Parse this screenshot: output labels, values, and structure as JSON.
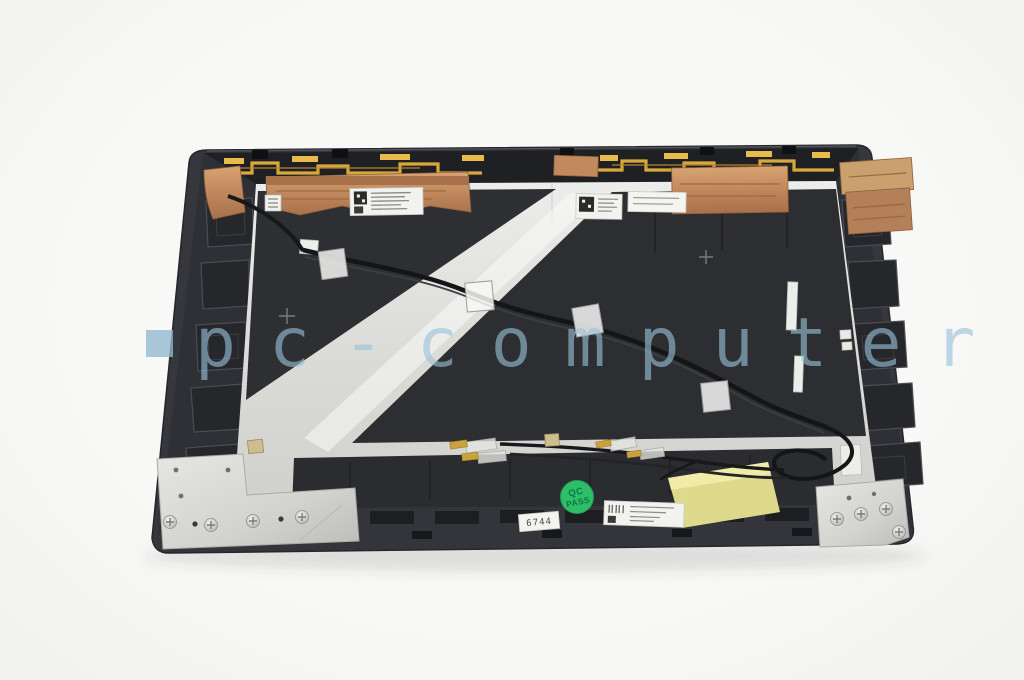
{
  "scene": {
    "description": "Rear/inner view of a dark laptop LCD back cover with antenna flex traces, copper shielding tape, black mylar sheets, a taped diagonal antenna cable, hinge brackets, part labels and a QC sticker, photographed on a white background",
    "background_color": "#f7f7f5"
  },
  "watermark": {
    "logo_icon": "square",
    "text": "pc-computer",
    "color": "#98c1da"
  },
  "qc_sticker": {
    "line1": "QC",
    "line2": "PASS",
    "bg_color": "#2ebd69",
    "text_color": "#0a7c3e"
  },
  "inventory_sticker": {
    "text": "6744"
  },
  "part_colors": {
    "cover_plastic": "#36373c",
    "mylar_sheet": "#2e2f32",
    "foil": "#e4e4e1",
    "copper_tape": "#c28a5c",
    "antenna_trace_gold": "#d9a83a",
    "tape_yellow": "#e9e390",
    "hinge_metal": "#d8d9d5"
  }
}
